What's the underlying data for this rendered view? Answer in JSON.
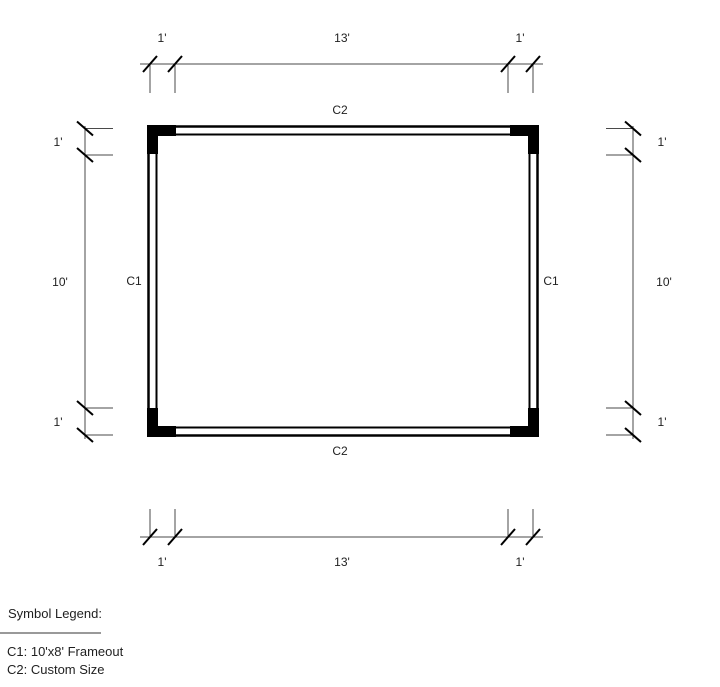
{
  "drawing": {
    "symbols": {
      "c2_top": "C2",
      "c2_bottom": "C2",
      "c1_left": "C1",
      "c1_right": "C1"
    },
    "dims": {
      "top": {
        "left": "1'",
        "mid": "13'",
        "right": "1'"
      },
      "bottom": {
        "left": "1'",
        "mid": "13'",
        "right": "1'"
      },
      "left": {
        "top": "1'",
        "mid": "10'",
        "bottom": "1'"
      },
      "right": {
        "top": "1'",
        "mid": "10'",
        "bottom": "1'"
      }
    }
  },
  "legend": {
    "title": "Symbol Legend:",
    "entries": [
      {
        "label": "C1: 10'x8' Frameout"
      },
      {
        "label": "C2: Custom Size"
      }
    ]
  },
  "colors": {
    "background": "#ffffff",
    "wall": "#000000",
    "dimension_line": "#4a4a4a",
    "text": "#1f1f1f",
    "legend_divider": "#999999"
  }
}
